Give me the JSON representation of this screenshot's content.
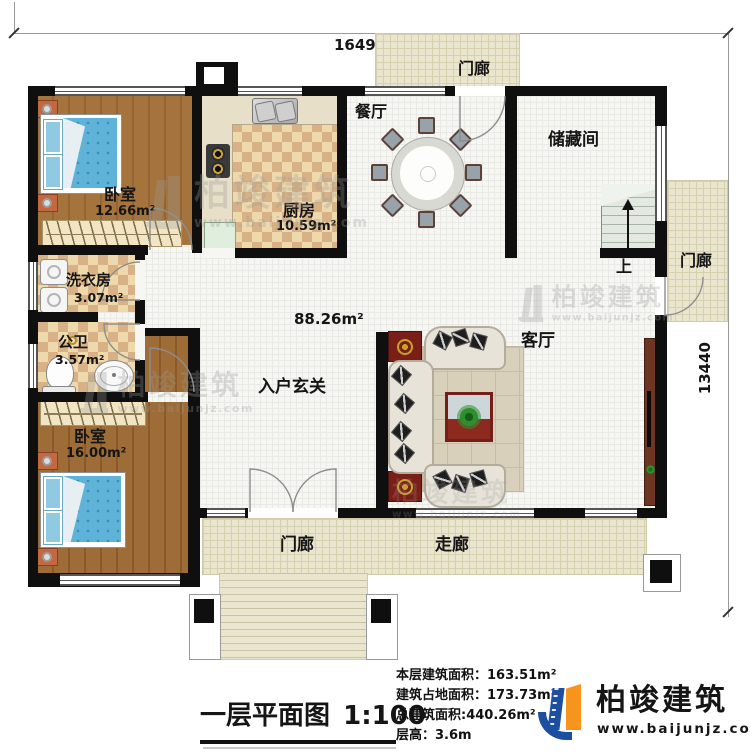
{
  "dimensions": {
    "top": "16490",
    "right": "13440"
  },
  "rooms": {
    "porch_top": {
      "name": "门廊"
    },
    "dining": {
      "name": "餐厅"
    },
    "storage": {
      "name": "储藏间"
    },
    "kitchen": {
      "name": "厨房",
      "area": "10.59m²"
    },
    "bedroom1": {
      "name": "卧室",
      "area": "12.66m²"
    },
    "laundry": {
      "name": "洗衣房",
      "area": "3.07m²"
    },
    "bathroom": {
      "name": "公卫",
      "area": "3.57m²"
    },
    "bedroom2": {
      "name": "卧室",
      "area": "16.00m²"
    },
    "hall": {
      "name": "入户玄关",
      "area": "88.26m²"
    },
    "living": {
      "name": "客厅"
    },
    "porch_right": {
      "name": "门廊"
    },
    "porch_bottom": {
      "name": "门廊"
    },
    "corridor": {
      "name": "走廊"
    },
    "stairs": {
      "direction": "上"
    }
  },
  "title": {
    "text": "一层平面图",
    "scale": "1:100"
  },
  "stats": {
    "items": [
      {
        "label": "本层建筑面积：",
        "value": "163.51m²"
      },
      {
        "label": "建筑占地面积：",
        "value": "173.73m²"
      },
      {
        "label": "总建筑面积:",
        "value": "440.26m²"
      },
      {
        "label": "层高：",
        "value": "3.6m"
      }
    ]
  },
  "logo": {
    "name": "柏竣建筑",
    "url": "www.baijunjz.com"
  },
  "watermark": {
    "name": "柏竣建筑",
    "url": "www.baijunjz.com"
  },
  "colors": {
    "wall": "#0f0f0f",
    "porch_tile": "#e9e5cf",
    "checker_dark": "#d8b286",
    "wood": "#a5743d",
    "logo_blue": "#1c4fa0",
    "logo_orange": "#f7941d"
  }
}
